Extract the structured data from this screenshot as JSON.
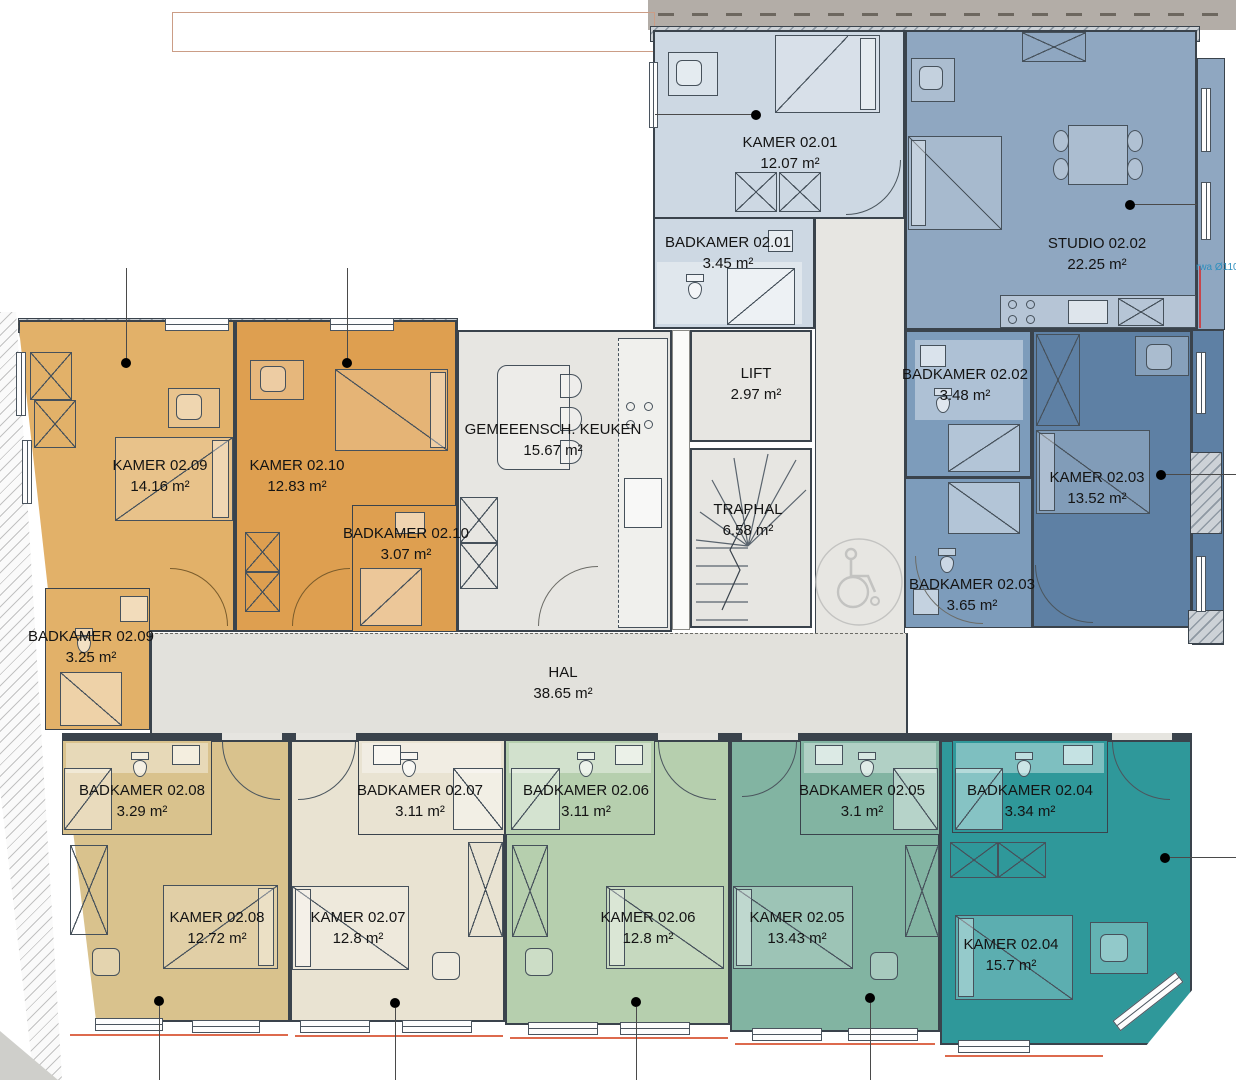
{
  "plan_title": "Verdiepingsplan 2e verdieping",
  "rooms": [
    {
      "id": "kamer-02-01",
      "name": "KAMER 02.01",
      "area": "12.07 m²"
    },
    {
      "id": "badkamer-02-01",
      "name": "BADKAMER 02.01",
      "area": "3.45 m²"
    },
    {
      "id": "studio-02-02",
      "name": "STUDIO 02.02",
      "area": "22.25 m²"
    },
    {
      "id": "badkamer-02-02",
      "name": "BADKAMER 02.02",
      "area": "3.48 m²"
    },
    {
      "id": "kamer-02-03",
      "name": "KAMER 02.03",
      "area": "13.52 m²"
    },
    {
      "id": "badkamer-02-03",
      "name": "BADKAMER 02.03",
      "area": "3.65 m²"
    },
    {
      "id": "gemeensch-keuken",
      "name": "GEMEEENSCH. KEUKEN",
      "area": "15.67 m²"
    },
    {
      "id": "lift",
      "name": "LIFT",
      "area": "2.97 m²"
    },
    {
      "id": "traphal",
      "name": "TRAPHAL",
      "area": "6.58 m²"
    },
    {
      "id": "hal",
      "name": "HAL",
      "area": "38.65 m²"
    },
    {
      "id": "kamer-02-09",
      "name": "KAMER 02.09",
      "area": "14.16 m²"
    },
    {
      "id": "kamer-02-10",
      "name": "KAMER 02.10",
      "area": "12.83 m²"
    },
    {
      "id": "badkamer-02-10",
      "name": "BADKAMER 02.10",
      "area": "3.07 m²"
    },
    {
      "id": "badkamer-02-09",
      "name": "BADKAMER 02.09",
      "area": "3.25 m²"
    },
    {
      "id": "badkamer-02-08",
      "name": "BADKAMER 02.08",
      "area": "3.29 m²"
    },
    {
      "id": "badkamer-02-07",
      "name": "BADKAMER 02.07",
      "area": "3.11 m²"
    },
    {
      "id": "badkamer-02-06",
      "name": "BADKAMER 02.06",
      "area": "3.11 m²"
    },
    {
      "id": "badkamer-02-05",
      "name": "BADKAMER 02.05",
      "area": "3.1 m²"
    },
    {
      "id": "badkamer-02-04",
      "name": "BADKAMER 02.04",
      "area": "3.34 m²"
    },
    {
      "id": "kamer-02-08",
      "name": "KAMER 02.08",
      "area": "12.72 m²"
    },
    {
      "id": "kamer-02-07",
      "name": "KAMER 02.07",
      "area": "12.8 m²"
    },
    {
      "id": "kamer-02-06",
      "name": "KAMER 02.06",
      "area": "12.8 m²"
    },
    {
      "id": "kamer-02-05",
      "name": "KAMER 02.05",
      "area": "13.43 m²"
    },
    {
      "id": "kamer-02-04",
      "name": "KAMER 02.04",
      "area": "15.7 m²"
    }
  ],
  "annotations": {
    "pipe_note": "rwa Ø110"
  },
  "palette": {
    "kamer_02_01": "#cdd8e3",
    "studio_02_02": "#8fa7c1",
    "badkamer_02_02": "#7d9cbb",
    "kamer_02_03": "#5e80a4",
    "kamer_02_09": "#e2b169",
    "kamer_02_10": "#de9f50",
    "common_gray": "#e7e6e2",
    "hal_gray": "#e2e1dc",
    "kamer_02_08": "#d9c28d",
    "kamer_02_07": "#e9e3d2",
    "kamer_02_06": "#b6cfae",
    "kamer_02_05": "#82b4a2",
    "kamer_02_04": "#2f989a",
    "wall": "#3a434c",
    "sill_red": "#dd6a4d",
    "road_gray": "#b3ada7"
  }
}
